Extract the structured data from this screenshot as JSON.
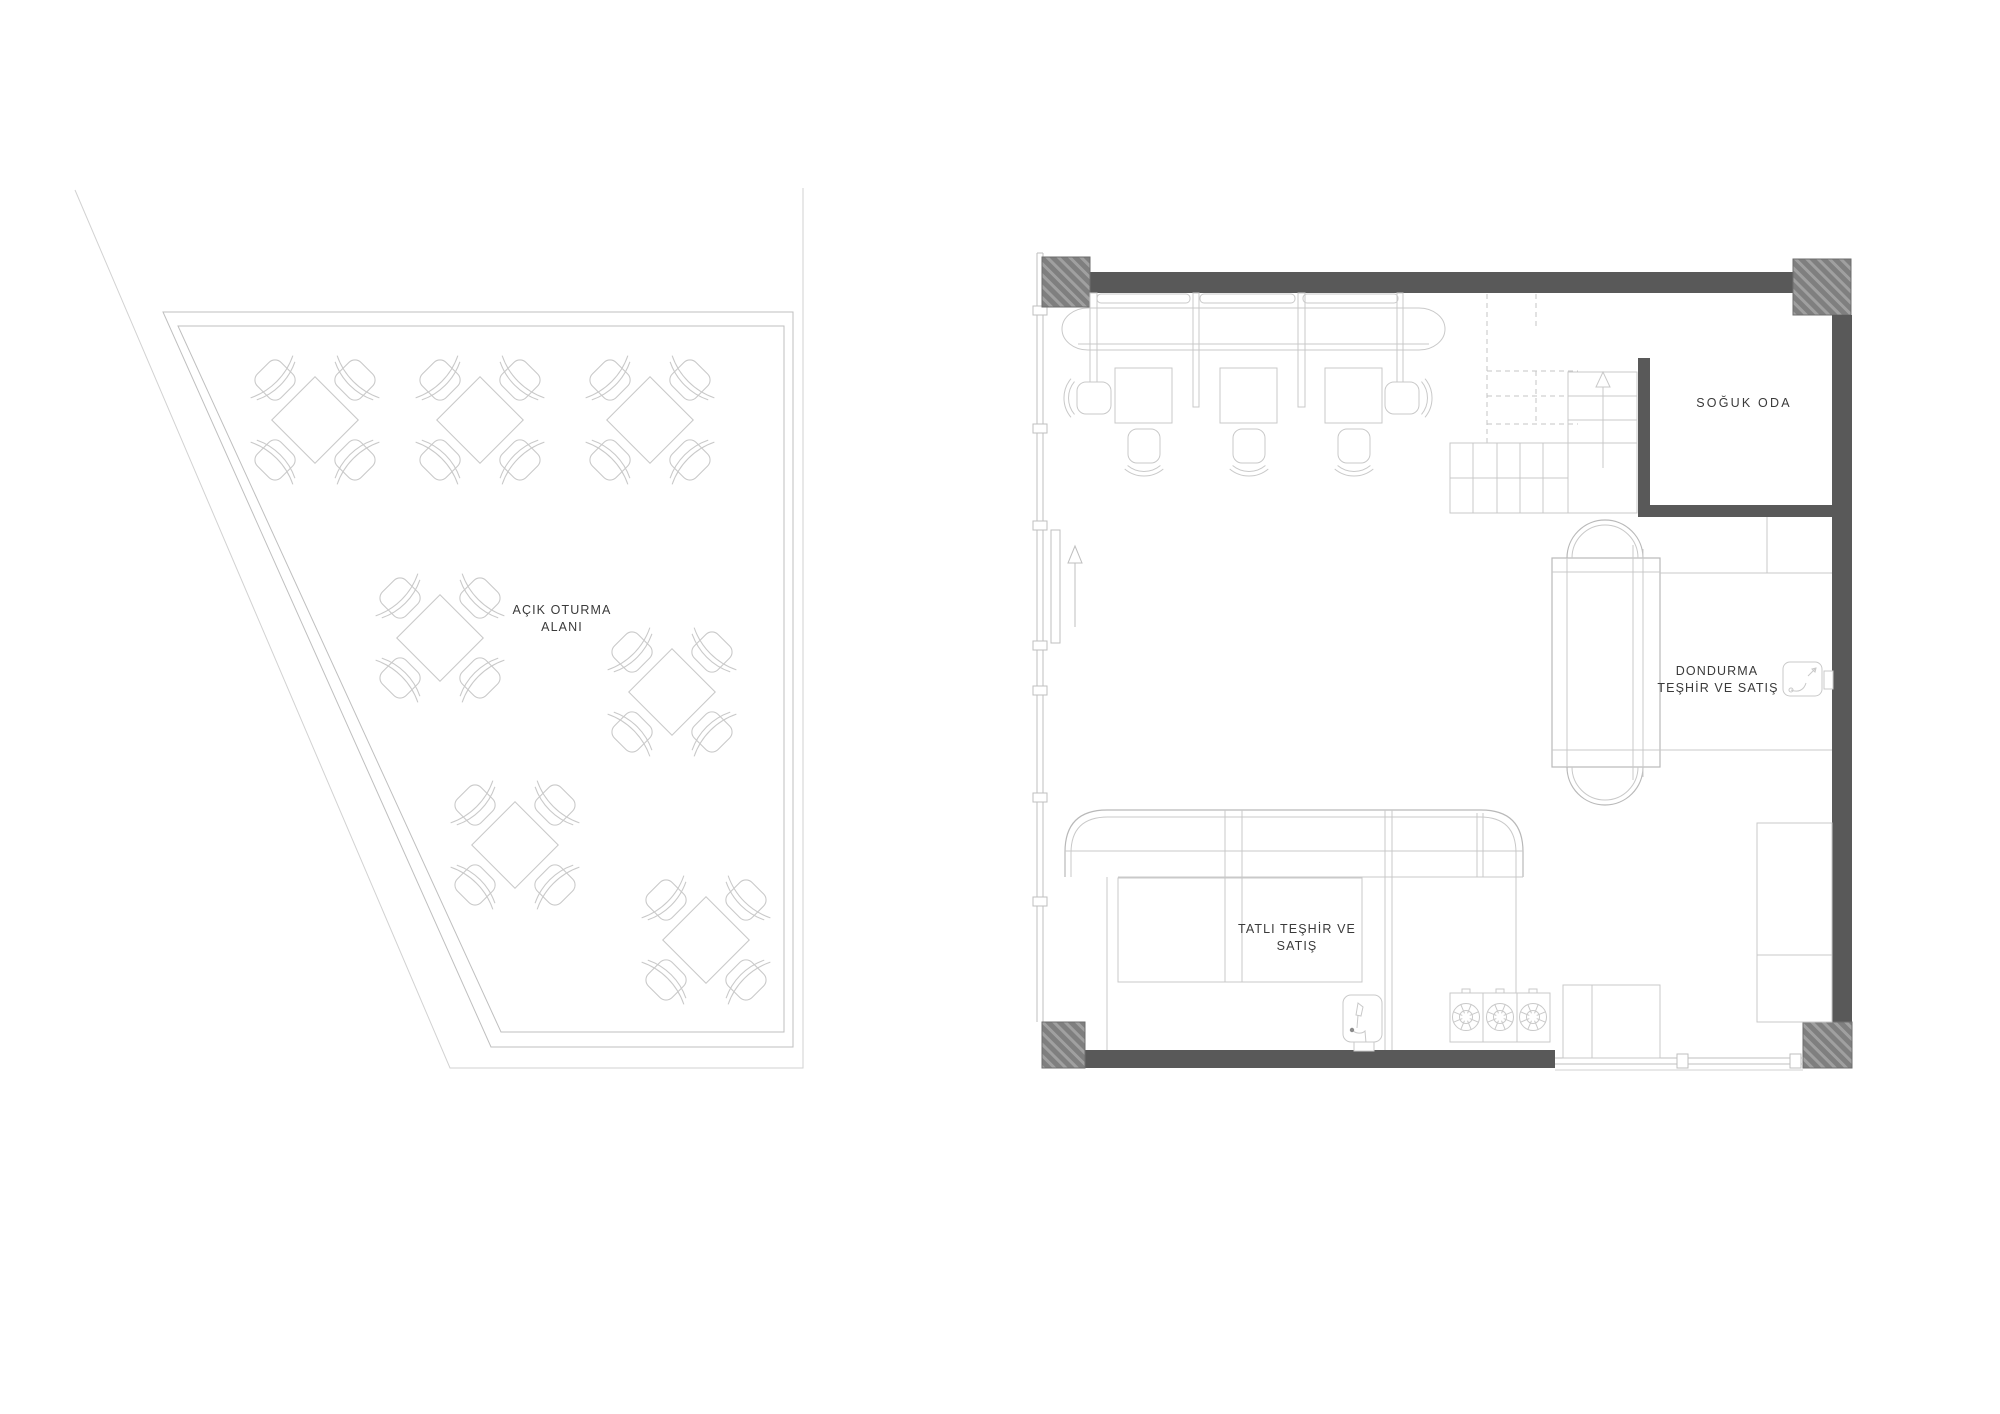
{
  "drawing": {
    "type": "architectural floor plan",
    "sheets": 2
  },
  "areas": {
    "outdoor": {
      "label_line1": "AÇIK OTURMA",
      "label_line2": "ALANI",
      "table_count": 7,
      "chairs_per_table": 4
    },
    "cold_room": {
      "label": "SOĞUK ODA"
    },
    "ice_cream": {
      "label_line1": "DONDURMA",
      "label_line2": "TEŞHİR VE SATIŞ"
    },
    "dessert": {
      "label_line1": "TATLI TEŞHİR VE",
      "label_line2": "SATIŞ"
    },
    "booth": {
      "table_count": 3,
      "divider_count": 4
    },
    "kitchen": {
      "burner_count": 3,
      "sink_count": 2
    }
  },
  "icons": {
    "entry-arrow-icon": "↑",
    "stair-up-arrow-icon": "△",
    "burner-icon": "⊛",
    "faucet-icon": "tap glyph",
    "table-icon": "diamond table with 4 chairs"
  },
  "colors": {
    "wall": "#595959",
    "hatch_base": "#7f7f7f",
    "hatch_stripe": "#a0a0a0",
    "line_light": "#d2d2d2",
    "line_mid": "#c6c6c6",
    "text": "#3a3a3a",
    "background": "#ffffff"
  }
}
